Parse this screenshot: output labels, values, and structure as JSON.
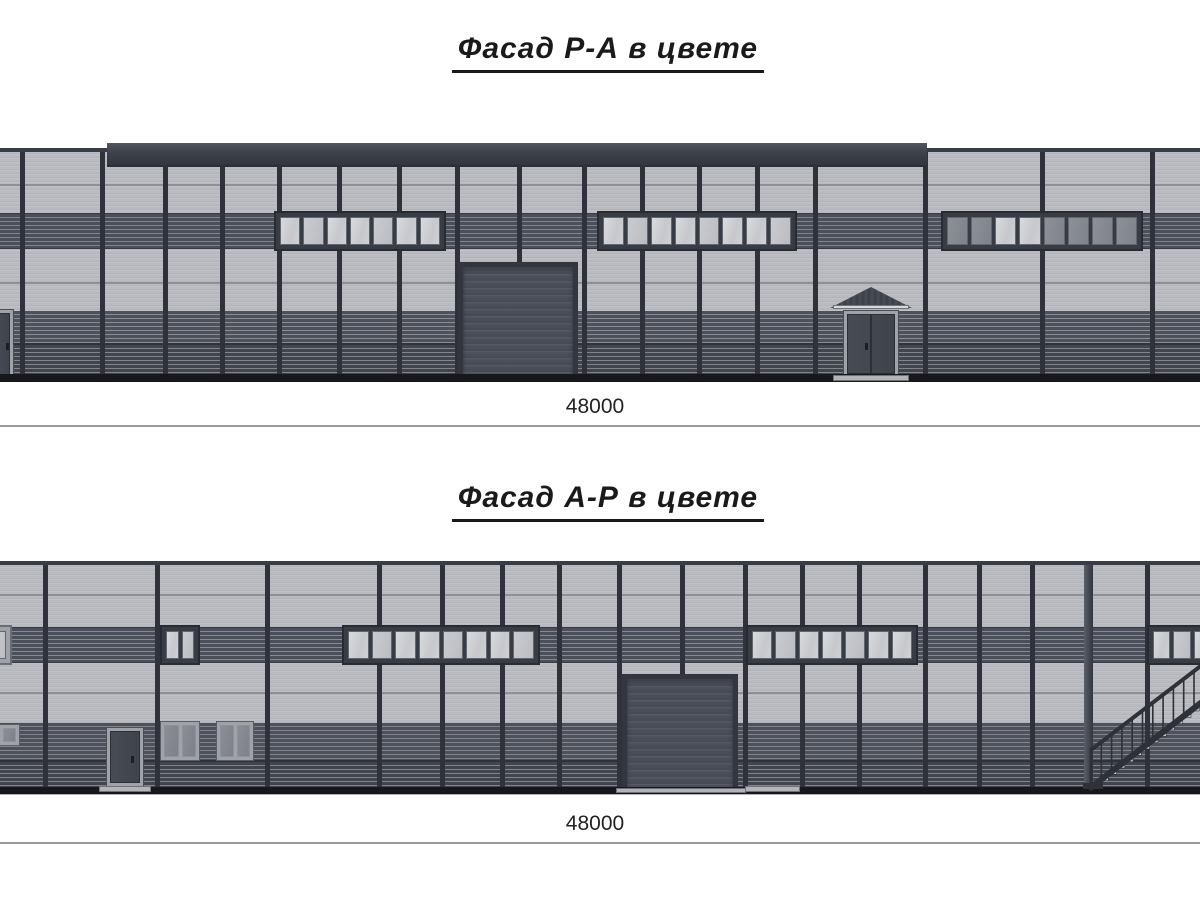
{
  "sheet": {
    "background": "#ffffff",
    "drawing_type": "building elevations in color"
  },
  "colors": {
    "panel_light": "#b9bbc1",
    "panel_rib_light": "#c6c8cd",
    "panel_rib_dark": "#aaacb2",
    "seam": "#8e9096",
    "band_dark": "#4b4f5a",
    "wainscot_upper": "#4d515c",
    "wainscot_lower": "#41454e",
    "fascia": "#3f434c",
    "mullion": "#2f323a",
    "frame_dark": "#383c44",
    "frame_light": "#9fa2a9",
    "glass_light": "#ccced3",
    "glass_dark": "#83868e",
    "rollup": "#4b4f58",
    "rollup_frame": "#33363e",
    "base_line": "#17181c",
    "pad": "#b2b4ba",
    "stair": "#2e3138",
    "dim_line": "#9a9a9a",
    "text": "#1a1a1a"
  },
  "facade_top": {
    "title": "Фасад Р-А в цвете",
    "dimension": "48000",
    "frame": {
      "top": 143,
      "height": 240
    },
    "wall": {
      "top": 150,
      "bottom": 382
    },
    "cap": {
      "y": 148,
      "h": 4
    },
    "fascia": {
      "x": 107,
      "y": 143,
      "w": 820,
      "h": 24
    },
    "band": {
      "y": 213,
      "h": 36
    },
    "window_row": {
      "y": 211,
      "h": 40
    },
    "seams": [
      184,
      282
    ],
    "wainscot": {
      "y": 311,
      "seam": 343
    },
    "base": {
      "y": 374,
      "h": 8
    },
    "mullions": [
      20,
      100,
      163,
      220,
      277,
      337,
      397,
      455,
      517,
      582,
      640,
      697,
      755,
      813,
      923,
      1040,
      1150
    ],
    "windows": [
      {
        "x": 274,
        "w": 172,
        "panes": 7,
        "glass": "light"
      },
      {
        "x": 597,
        "w": 200,
        "panes": 8,
        "glass": "light"
      },
      {
        "x": 941,
        "w": 202,
        "panes": 8,
        "glass": "dark",
        "light_panes": [
          2,
          3
        ]
      }
    ],
    "rollup_doors": [
      {
        "x": 458,
        "y": 262,
        "w": 120,
        "h": 118
      }
    ],
    "entry_doors": [
      {
        "x": 843,
        "y": 310,
        "w": 56,
        "h": 68,
        "double": true,
        "canopy": {
          "x": 830,
          "y": 287,
          "w": 82,
          "h": 21
        }
      },
      {
        "x": -8,
        "y": 309,
        "w": 22,
        "h": 71,
        "double": false
      }
    ],
    "pads": [
      {
        "x": 833,
        "w": 76,
        "y": 375,
        "h": 6
      }
    ]
  },
  "facade_bottom": {
    "title": "Фасад А-Р в цвете",
    "dimension": "48000",
    "frame": {
      "top": 556,
      "height": 242
    },
    "wall": {
      "top": 563,
      "bottom": 795
    },
    "cap": {
      "y": 561,
      "h": 4
    },
    "band": {
      "y": 627,
      "h": 36
    },
    "window_row": {
      "y": 625,
      "h": 40
    },
    "seams": [
      594,
      692
    ],
    "wainscot": {
      "y": 723,
      "seam": 760
    },
    "base": {
      "y": 787,
      "h": 7
    },
    "mullions": [
      43,
      155,
      265,
      377,
      440,
      500,
      557,
      617,
      680,
      743,
      800,
      857,
      923,
      977,
      1030,
      1145
    ],
    "downspout": {
      "x": 1084,
      "w": 9
    },
    "windows": [
      {
        "x": -28,
        "w": 40,
        "panes": 2,
        "glass": "light",
        "frame": "light"
      },
      {
        "x": 160,
        "w": 40,
        "panes": 2,
        "glass": "light"
      },
      {
        "x": 342,
        "w": 198,
        "panes": 8,
        "glass": "light"
      },
      {
        "x": 746,
        "w": 172,
        "panes": 7,
        "glass": "light"
      },
      {
        "x": 1147,
        "w": 70,
        "panes": 3,
        "glass": "light"
      }
    ],
    "small_windows": [
      {
        "x": -18,
        "y": 724,
        "w": 38,
        "h": 22
      },
      {
        "x": 160,
        "y": 721,
        "w": 40,
        "h": 40
      },
      {
        "x": 216,
        "y": 721,
        "w": 38,
        "h": 40
      }
    ],
    "rollup_doors": [
      {
        "x": 622,
        "y": 674,
        "w": 116,
        "h": 116
      }
    ],
    "entry_doors": [
      {
        "x": 106,
        "y": 727,
        "w": 38,
        "h": 60,
        "double": false
      }
    ],
    "pads": [
      {
        "x": 99,
        "w": 52,
        "y": 786,
        "h": 6
      },
      {
        "x": 745,
        "w": 55,
        "y": 786,
        "h": 6
      },
      {
        "x": 616,
        "w": 130,
        "y": 788,
        "h": 5
      }
    ],
    "stair": {
      "x": 1075,
      "y": 650,
      "w": 140,
      "h": 146
    }
  }
}
